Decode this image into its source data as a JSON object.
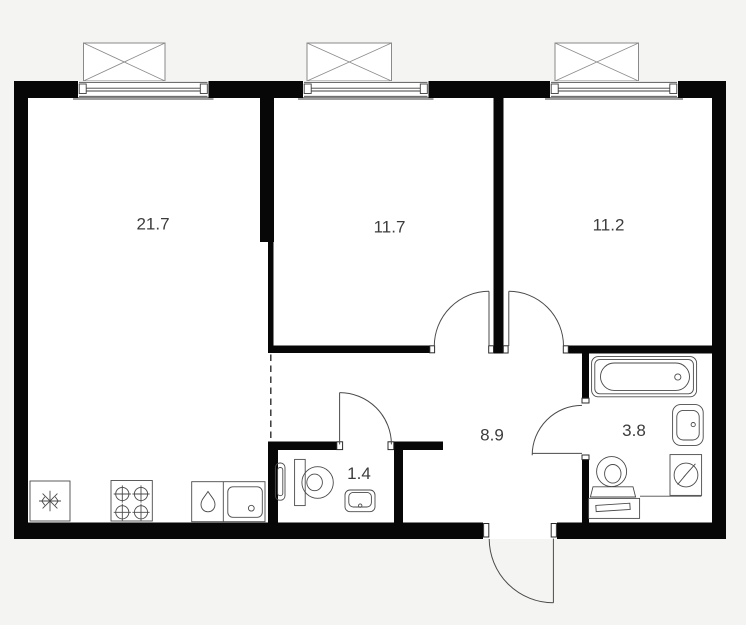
{
  "plan": {
    "type": "apartment-floor-plan",
    "rooms": [
      {
        "id": "living-kitchen",
        "area": "21.7"
      },
      {
        "id": "bedroom-1",
        "area": "11.7"
      },
      {
        "id": "bedroom-2",
        "area": "11.2"
      },
      {
        "id": "hallway",
        "area": "8.9"
      },
      {
        "id": "bathroom",
        "area": "3.8"
      },
      {
        "id": "wc",
        "area": "1.4"
      }
    ],
    "fixtures": [
      "fridge-icon",
      "stove-icon",
      "kitchen-sink-icon",
      "towel-rail-icon",
      "toilet-icon",
      "washbasin-icon",
      "bathtub-icon",
      "washing-machine-icon",
      "vanity-cabinet-icon"
    ],
    "windows_count": 3,
    "doors_count": 5,
    "colors": {
      "background": "#f4f4f2",
      "floor": "#ffffff",
      "wall": "#070707",
      "line": "#4a4a4a",
      "window_line": "#8a8a8a",
      "label": "#3c3c3c"
    }
  }
}
